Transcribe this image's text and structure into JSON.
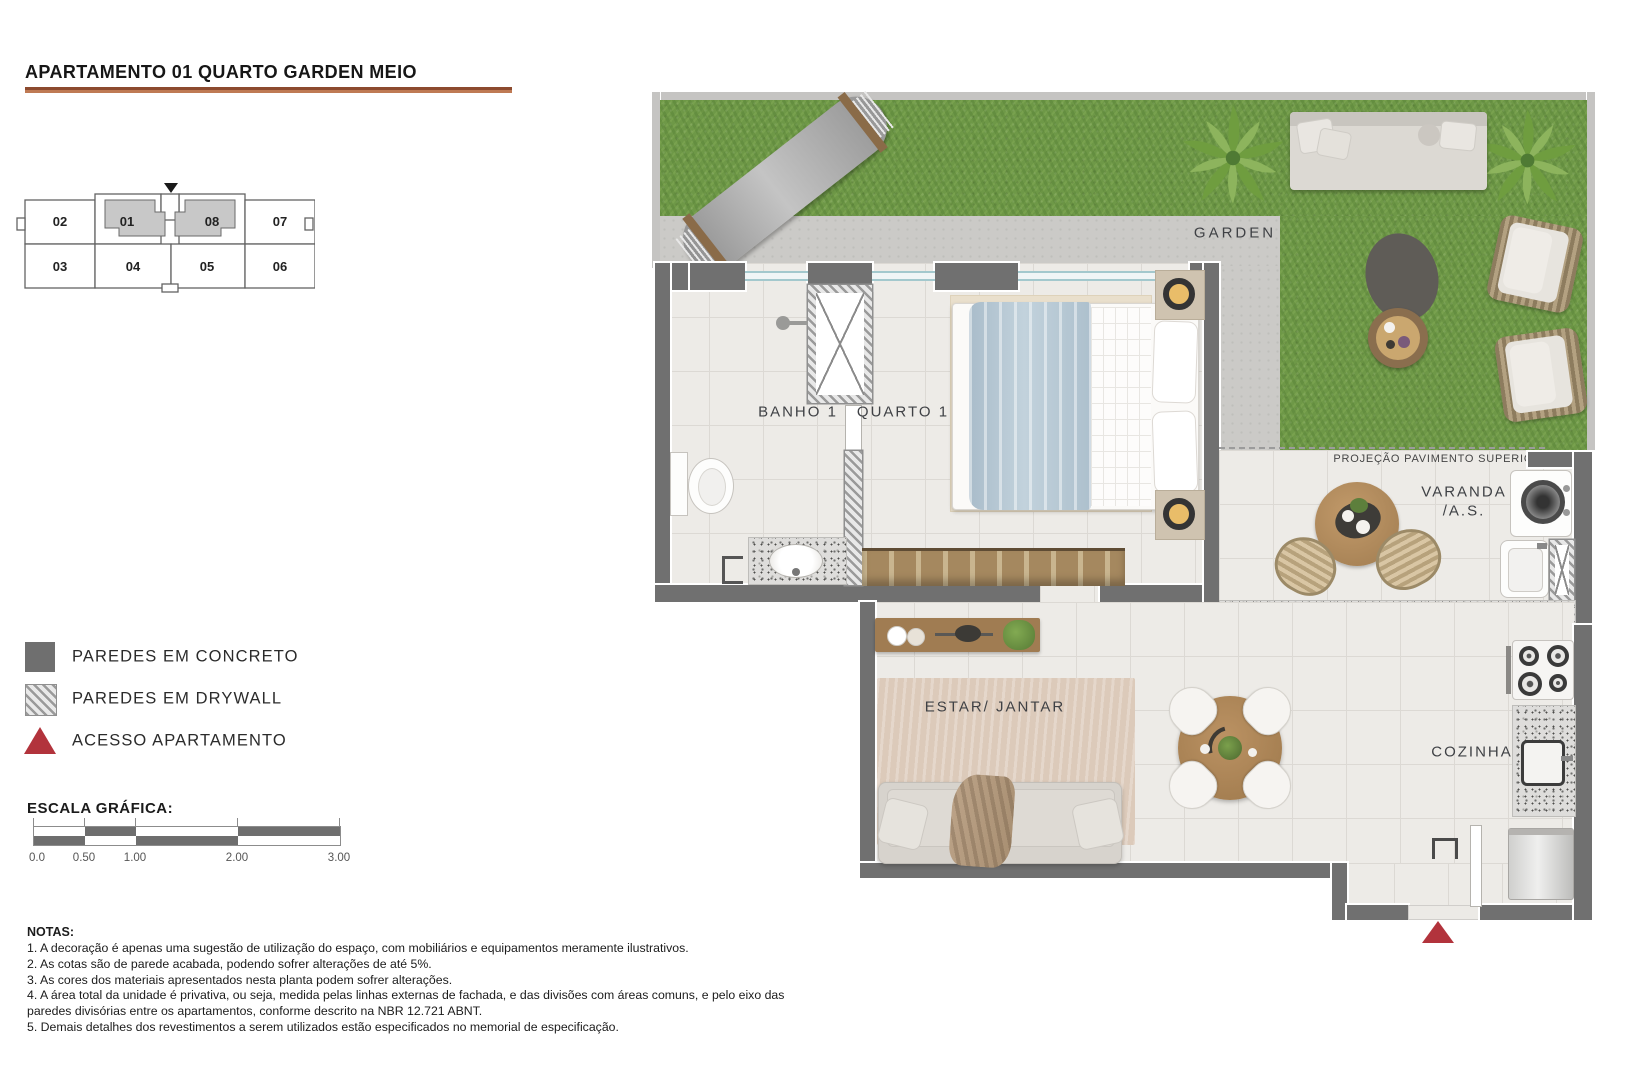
{
  "title": "APARTAMENTO 01 QUARTO GARDEN MEIO",
  "key_plan": {
    "marker_icon": "triangle-down",
    "units": [
      {
        "label": "02",
        "highlighted": false
      },
      {
        "label": "01",
        "highlighted": true
      },
      {
        "label": "08",
        "highlighted": true
      },
      {
        "label": "07",
        "highlighted": false
      },
      {
        "label": "03",
        "highlighted": false
      },
      {
        "label": "04",
        "highlighted": false
      },
      {
        "label": "05",
        "highlighted": false
      },
      {
        "label": "06",
        "highlighted": false
      }
    ]
  },
  "legend": {
    "items": [
      {
        "label": "PAREDES EM CONCRETO",
        "swatch": "concrete-solid",
        "color": "#6f6f6f"
      },
      {
        "label": "PAREDES EM DRYWALL",
        "swatch": "diagonal-hatch",
        "color": "#9a9a9a"
      },
      {
        "label": "ACESSO APARTAMENTO",
        "swatch": "red-triangle",
        "color": "#b2333c"
      }
    ]
  },
  "scale_bar": {
    "heading": "ESCALA GRÁFICA:",
    "tick_labels": [
      "0.0",
      "0.50",
      "1.00",
      "2.00",
      "3.00"
    ]
  },
  "notes": {
    "heading": "NOTAS:",
    "items": [
      "1. A decoração é apenas uma sugestão de utilização do espaço, com mobiliários e equipamentos meramente ilustrativos.",
      "2. As cotas são de parede acabada, podendo sofrer alterações de até 5%.",
      "3. As cores dos materiais apresentados nesta planta podem sofrer alterações.",
      "4. A área total da unidade é privativa, ou seja, medida pelas linhas externas de fachada, e das divisões com áreas comuns, e pelo eixo das paredes divisórias entre os apartamentos, conforme descrito na NBR 12.721 ABNT.",
      "5. Demais detalhes dos revestimentos a serem utilizados estão especificados no memorial de especificação."
    ]
  },
  "plan": {
    "labels": {
      "garden": "GARDEN",
      "banho": "BANHO 1",
      "quarto": "QUARTO 1",
      "projecao": "PROJEÇÃO PAVIMENTO SUPERIOR",
      "varanda_line1": "VARANDA",
      "varanda_line2": "/A.S.",
      "estar_jantar": "ESTAR/ JANTAR",
      "cozinha": "COZINHA"
    }
  },
  "colors": {
    "title_underline": "#a75c3c",
    "wall_concrete": "#707070",
    "access_red": "#b2333c",
    "grass_green": "#6e9847",
    "path_concrete": "#cbcac7",
    "floor_tile": "#edebe7",
    "wood": "#a8825c",
    "window_glass": "#a3c8cd"
  }
}
